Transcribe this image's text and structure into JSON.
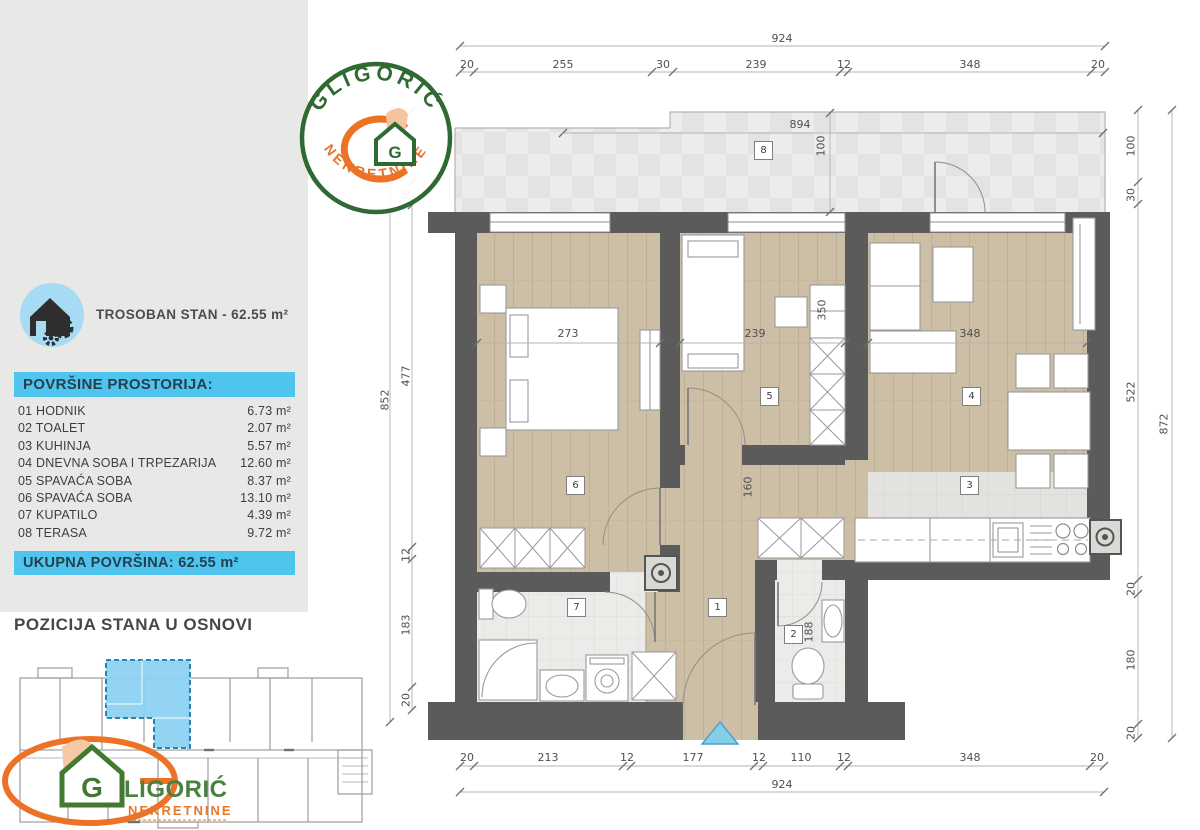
{
  "header": {
    "apartment_label": "TROSOBAN STAN - 62.55 m²"
  },
  "legend": {
    "title": "POVRŠINE PROSTORIJA:",
    "rows": [
      {
        "name": "01 HODNIK",
        "area": "6.73 m²"
      },
      {
        "name": "02 TOALET",
        "area": "2.07 m²"
      },
      {
        "name": "03 KUHINJA",
        "area": "5.57 m²"
      },
      {
        "name": "04 DNEVNA SOBA I TRPEZARIJA",
        "area": "12.60 m²"
      },
      {
        "name": "05 SPAVAĆA SOBA",
        "area": "8.37 m²"
      },
      {
        "name": "06 SPAVAĆA SOBA",
        "area": "13.10 m²"
      },
      {
        "name": "07 KUPATILO",
        "area": "4.39 m²"
      },
      {
        "name": "08 TERASA",
        "area": "9.72 m²"
      }
    ],
    "total": "UKUPNA POVRŠINA: 62.55 m²"
  },
  "position_section": {
    "title": "POZICIJA STANA U OSNOVI"
  },
  "brand": {
    "name": "GLIGORIĆ",
    "monogram": "G",
    "rest": "LIGORIĆ",
    "subtitle": "NEKRETNINE"
  },
  "plan": {
    "room_tags": {
      "hodnik": "1",
      "toalet": "2",
      "kuhinja": "3",
      "dnevna": "4",
      "spavaca_soba_5": "5",
      "spavaca_soba_6": "6",
      "kupatilo": "7",
      "terasa": "8"
    },
    "dims": {
      "top_total": "924",
      "top_segments": [
        "20",
        "255",
        "30",
        "239",
        "12",
        "348",
        "20"
      ],
      "bottom_segments": [
        "20",
        "213",
        "12",
        "177",
        "12",
        "110",
        "12",
        "348",
        "20"
      ],
      "bottom_total": "924",
      "left_total": "852",
      "left_chain": [
        "100",
        "30",
        "477",
        "12",
        "183",
        "20"
      ],
      "right_chain": [
        "100",
        "30",
        "522",
        "20",
        "180",
        "20"
      ],
      "right_total": "872",
      "terrace_width": "894",
      "terrace_depth": "100",
      "bedroom6_width": "273",
      "bedroom5_width": "239",
      "living_width": "348",
      "wardrobe_depth": "350",
      "hall_width": "160",
      "toilet_depth": "188"
    }
  },
  "colors": {
    "accent_cyan": "#4fc4ef",
    "highlight_blue": "#8bd0f2",
    "wall_gray": "#5c5b5b",
    "wood": "#cdbfa6",
    "logo_green": "#2e6a31",
    "logo_orange": "#ed7226"
  }
}
